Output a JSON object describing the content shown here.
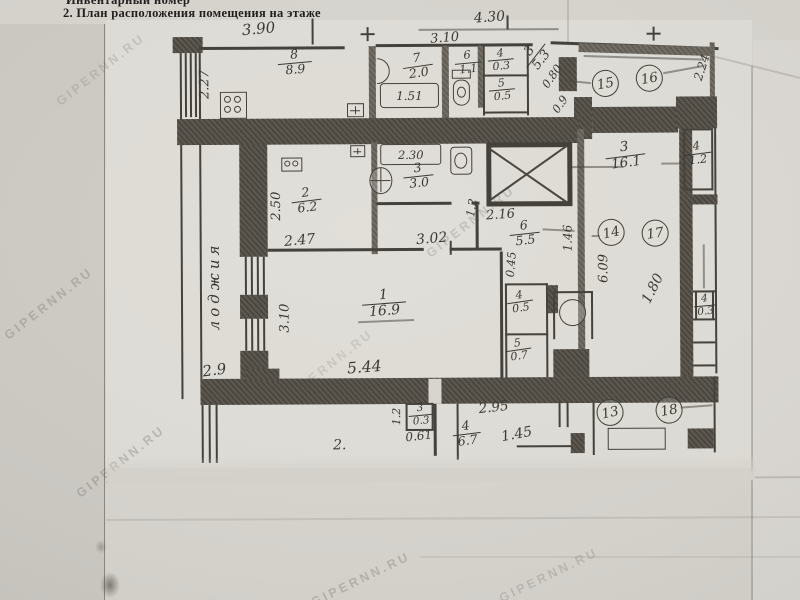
{
  "header": {
    "line1": "Инвентарный номер",
    "line2": "2. План расположения помещения на этаже"
  },
  "watermark": "GIPERNN.RU",
  "plan": {
    "loggia_label": "лоджия",
    "rooms": {
      "kitchen": {
        "num": "8",
        "area": "8.9"
      },
      "bath7": {
        "num": "7",
        "area": "2.0"
      },
      "wc6": {
        "num": "6",
        "area": "1.1"
      },
      "closet4": {
        "num": "4",
        "area": "0.3"
      },
      "closet5": {
        "num": "5",
        "area": "0.5"
      },
      "corridor3": {
        "num": "3",
        "area": "5.3"
      },
      "room2": {
        "num": "2",
        "area": "6.2"
      },
      "bath3": {
        "num": "3",
        "area": "3.0"
      },
      "hall6": {
        "num": "6",
        "area": "5.5"
      },
      "room1": {
        "num": "1",
        "area": "16.9"
      },
      "wardrobe4": {
        "num": "4",
        "area": "0.5"
      },
      "wardrobe5": {
        "num": "5",
        "area": "0.7"
      },
      "east3": {
        "num": "3",
        "area": "16.1"
      },
      "east4": {
        "num": "4",
        "area": "1.2"
      },
      "strip4": {
        "num": "4",
        "area": "0.3"
      },
      "south3": {
        "num": "3",
        "area": "0.3"
      },
      "south4": {
        "num": "4",
        "area": "6.7"
      },
      "south2_label": "2."
    },
    "units": {
      "u13": "13",
      "u14": "14",
      "u15": "15",
      "u16": "16",
      "u17": "17",
      "u18": "18"
    },
    "dims": {
      "kitchen_top": "3.90",
      "kitchen_left": "2.27",
      "bath_top": "3.10",
      "top_right": "4.30",
      "tub": "1.51",
      "tub2": "2.30",
      "room2_left": "2.50",
      "room2_bottom": "2.47",
      "bath3_bottom": "3.02",
      "bath3_door": "1.2",
      "shaft_bottom": "2.16",
      "hall_right": "1.46",
      "corridor_v": "6.09",
      "niche_v": "0.45",
      "room1_bottom": "5.44",
      "room1_left": "3.10",
      "loggia": "2.9",
      "south_v": "1.2",
      "south_1": "0.61",
      "south_2": "2.95",
      "south_3": "1.45",
      "east_diag": "1.80",
      "ne_diag": "2.24",
      "c_diag1": "0.80",
      "c_diag2": "0.9"
    },
    "icons": {
      "stove": "4-burner stove",
      "bathtub": "bathtub",
      "washbasin": "washbasin",
      "toilet": "toilet",
      "sink": "sink",
      "shaft": "elevator shaft (X)",
      "vent": "vent box",
      "socket": "socket box"
    }
  }
}
